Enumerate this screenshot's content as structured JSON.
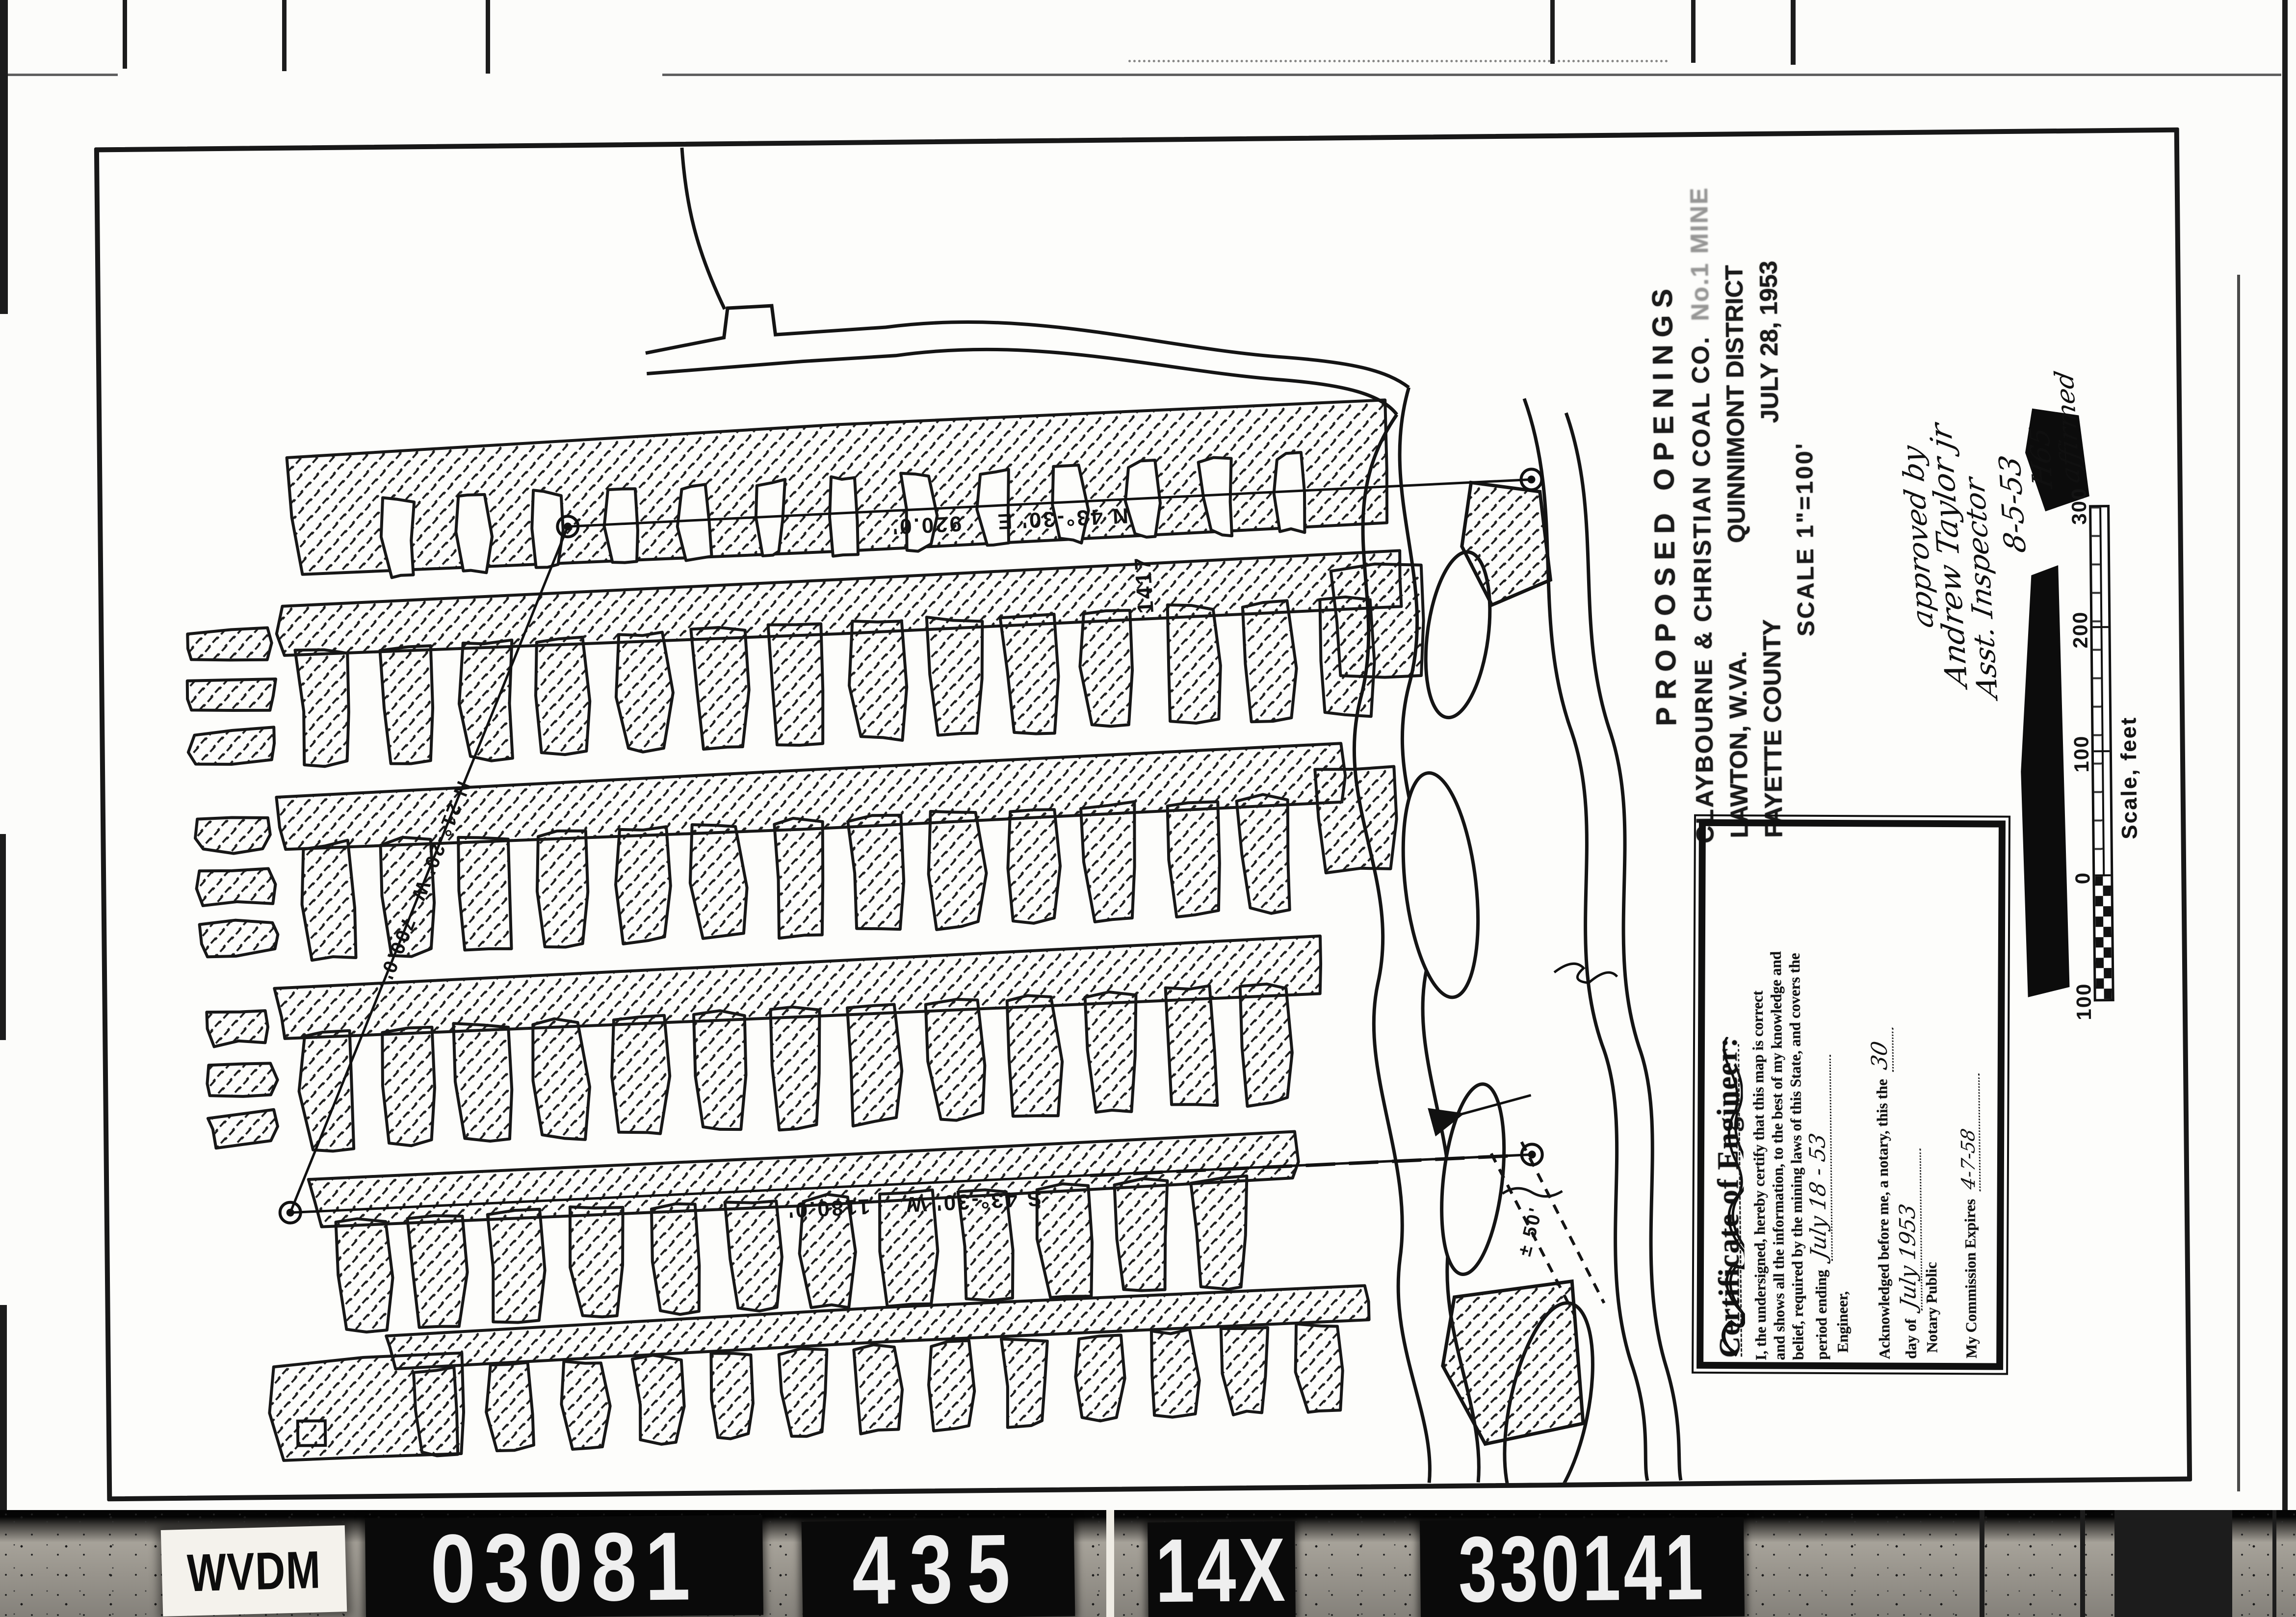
{
  "film": {
    "label": "WVDM",
    "codes": [
      "03081",
      "435",
      "14X",
      "330141"
    ]
  },
  "title_block": {
    "line1": "PROPOSED  OPENINGS",
    "company": "CLAYBOURNE & CHRISTIAN COAL CO.",
    "company_suffix": "No.1 MINE",
    "city": "LAWTON, W.VA.",
    "district": "QUINNIMONT DISTRICT",
    "county": "FAYETTE COUNTY",
    "date": "JULY 28, 1953",
    "scale": "SCALE 1\"=100'"
  },
  "approval": {
    "line1": "approved by",
    "line2": "Andrew Taylor jr",
    "line3": "Asst. Inspector",
    "date": "8-5-53",
    "initials": "H65",
    "note": "affirmed"
  },
  "scale_bar": {
    "ticks": [
      "100",
      "0",
      "100",
      "200",
      "300"
    ],
    "caption": "Scale, feet"
  },
  "certificate": {
    "heading": "Certificate of Engineer:",
    "body1": "I, the undersigned, hereby certify that this map is correct",
    "body2": "and shows all the information, to the best of my knowledge and",
    "body3": "belief, required by the mining laws of this State, and covers the",
    "period_label": "period ending",
    "period_value": "July 18 - 53",
    "engineer_label": "Engineer,",
    "ack_line": "Acknowledged before me, a notary, this the",
    "ack_day": "30",
    "day_of_label": "day of",
    "day_of_value": "July 1953",
    "notary_label": "Notary Public",
    "expires_label": "My Commission Expires",
    "expires_value": "4-7-58"
  },
  "survey": {
    "top_bearing": "N 43°-30' E",
    "top_distance": "920.0'",
    "bottom_bearing": "S 43°-30' W",
    "bottom_distance": "1180.0'",
    "diagonal_bearing": "N 21°-20' W",
    "diagonal_distance": "700.0'",
    "elevation": "1417",
    "offset_note": "± 50'"
  }
}
